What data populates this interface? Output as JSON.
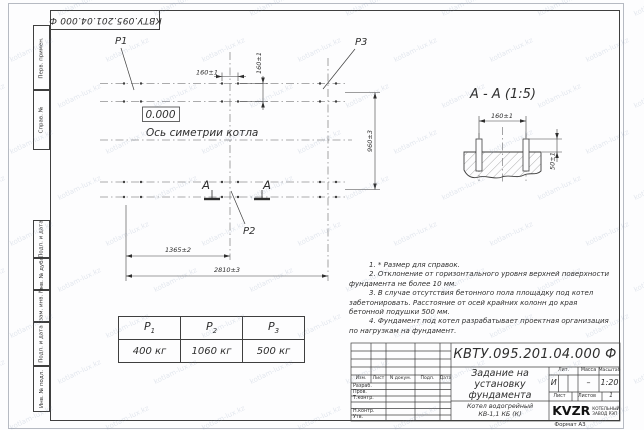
{
  "stamp_top": {
    "designation": "КВТУ.095.201.04.000 Ф"
  },
  "sidebar": {
    "top": [
      "Перв. примен.",
      "Справ. №"
    ],
    "bottom": [
      "Подп. и дата",
      "Инв. № дубл.",
      "Взам. инв. №",
      "Подп. и дата",
      "Инв. № подл."
    ]
  },
  "plan": {
    "labels": {
      "p1": "P1",
      "p2": "P2",
      "p3": "P3",
      "level": "0.000",
      "axis": "Ось симетрии котла",
      "section_letter": "А"
    },
    "dims": {
      "d160h": "160±1",
      "d160v": "160±1",
      "d960": "960±3",
      "d1365": "1365±2",
      "d2810": "2810±3"
    }
  },
  "section": {
    "title": "А - А (1:5)",
    "d160": "160±1",
    "d50": "50±1"
  },
  "notes": [
    "1. * Размер для справок.",
    "2. Отклонение от горизонтального уровня верхней поверхности фундамента не более 10 мм.",
    "3. В случае отсутствия бетонного пола площадку под котел забетонировать. Расстояние от осей крайних колонн до края бетонной подушки 500 мм.",
    "4. Фундамент под котел разрабатывает проектная организация по нагрузкам на фундамент."
  ],
  "loads_table": {
    "columns": [
      {
        "sym": "P",
        "sub": "1"
      },
      {
        "sym": "P",
        "sub": "2"
      },
      {
        "sym": "P",
        "sub": "3"
      }
    ],
    "values": [
      "400 кг",
      "1060 кг",
      "500 кг"
    ]
  },
  "title_block": {
    "designation": "КВТУ.095.201.04.000 Ф",
    "title_lines": [
      "Задание на",
      "установку",
      "фундамента"
    ],
    "product_lines": [
      "Котел водогрейный",
      "КВ-1,1 КБ (К)"
    ],
    "header_cols": [
      "Изм.",
      "Лист",
      "N докум.",
      "Подп.",
      "Дата"
    ],
    "roles": [
      "Разраб.",
      "Пров.",
      "Т.контр.",
      "Н.контр.",
      "Утв."
    ],
    "lit_label": "Лит.",
    "lit_value": "И",
    "mass_label": "Масса",
    "mass_value": "–",
    "scale_label": "Масштаб",
    "scale_value": "1:20",
    "sheet_label": "Лист",
    "sheets_label": "Листов",
    "sheets_value": "1",
    "company": "KVZR",
    "company_sub": [
      "КОТЕЛЬНЫЙ",
      "ЗАВОД РЭП"
    ],
    "format_note": "Формат А3"
  },
  "watermark": {
    "text": "kotlam-lux.kz"
  }
}
